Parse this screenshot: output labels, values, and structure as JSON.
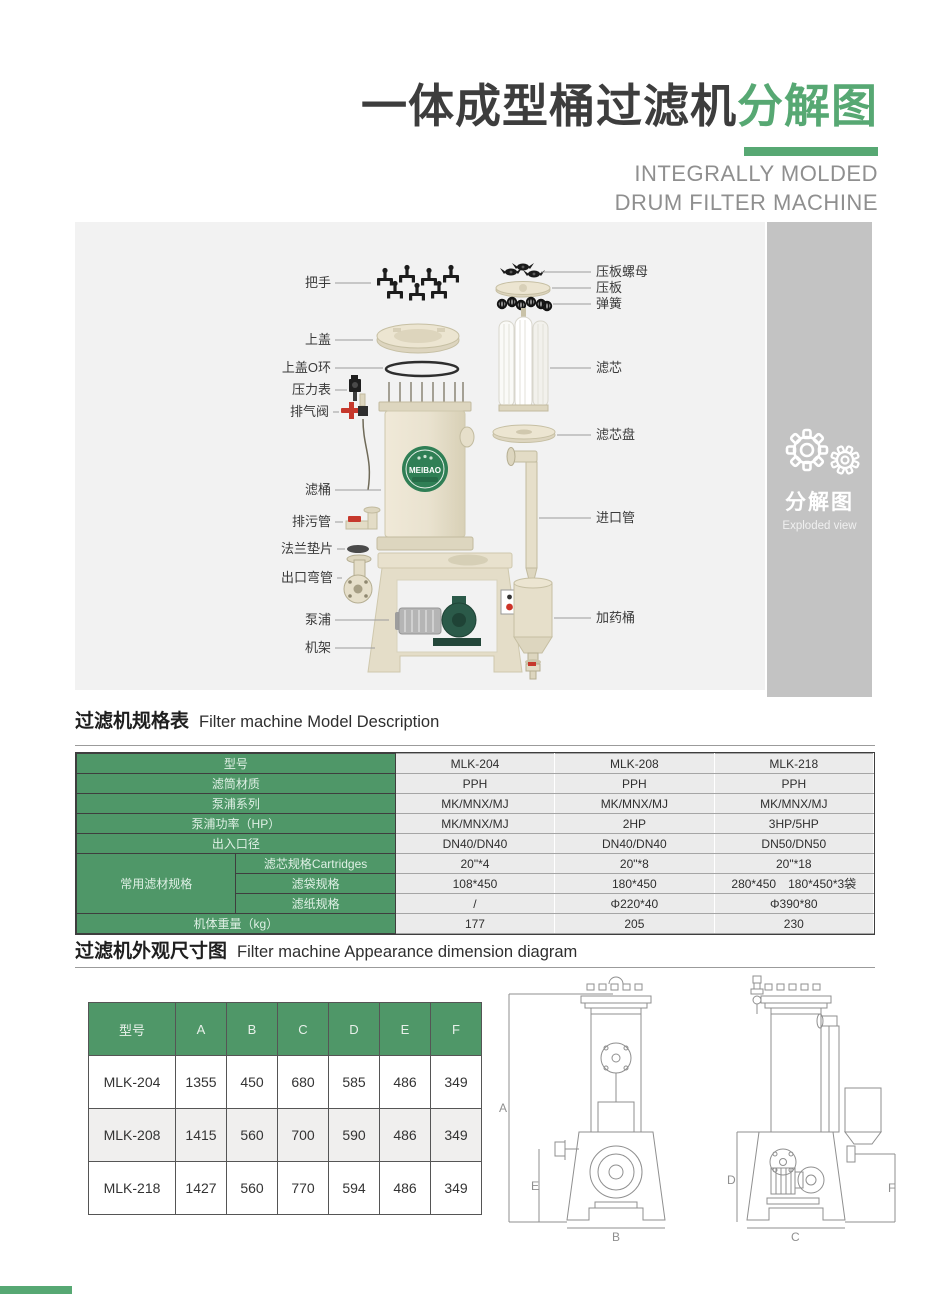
{
  "colors": {
    "accent_green": "#57a873",
    "table_green": "#4f9768",
    "sidebar_gray": "#c3c3c3",
    "panel_gray": "#f2f2f2"
  },
  "title": {
    "zh_main": "一体成型桶过滤机",
    "zh_accent": "分解图",
    "en_line1": "INTEGRALLY MOLDED",
    "en_line2": "DRUM FILTER MACHINE"
  },
  "sidebar": {
    "zh": "分解图",
    "en": "Exploded view"
  },
  "diagram": {
    "drum_logo": "MEIBAO",
    "parts_left": [
      "把手",
      "上盖",
      "上盖O环",
      "压力表",
      "排气阀",
      "滤桶",
      "排污管",
      "法兰垫片",
      "出口弯管",
      "泵浦",
      "机架"
    ],
    "parts_right": [
      "压板螺母",
      "压板",
      "弹簧",
      "滤芯",
      "滤芯盘",
      "进口管",
      "加药桶"
    ]
  },
  "sections": {
    "spec": {
      "zh": "过滤机规格表",
      "en": "Filter machine Model Description"
    },
    "dim": {
      "zh": "过滤机外观尺寸图",
      "en": "Filter machine Appearance dimension diagram"
    }
  },
  "spec_table": {
    "model_row": {
      "label": "型号",
      "values": [
        "MLK-204",
        "MLK-208",
        "MLK-218"
      ]
    },
    "rows": [
      {
        "label": "滤筒材质",
        "values": [
          "PPH",
          "PPH",
          "PPH"
        ]
      },
      {
        "label": "泵浦系列",
        "values": [
          "MK/MNX/MJ",
          "MK/MNX/MJ",
          "MK/MNX/MJ"
        ]
      },
      {
        "label": "泵浦功率（HP）",
        "values": [
          "MK/MNX/MJ",
          "2HP",
          "3HP/5HP"
        ]
      },
      {
        "label": "出入口径",
        "values": [
          "DN40/DN40",
          "DN40/DN40",
          "DN50/DN50"
        ]
      }
    ],
    "media_group": {
      "label": "常用滤材规格",
      "rows": [
        {
          "label": "滤芯规格Cartridges",
          "values": [
            "20\"*4",
            "20\"*8",
            "20\"*18"
          ]
        },
        {
          "label": "滤袋规格",
          "values": [
            "108*450",
            "180*450",
            "280*450　180*450*3袋"
          ]
        },
        {
          "label": "滤纸规格",
          "values": [
            "/",
            "Φ220*40",
            "Φ390*80"
          ]
        }
      ]
    },
    "weight_row": {
      "label": "机体重量（kg）",
      "values": [
        "177",
        "205",
        "230"
      ]
    }
  },
  "dim_table": {
    "headers": [
      "型号",
      "A",
      "B",
      "C",
      "D",
      "E",
      "F"
    ],
    "rows": [
      [
        "MLK-204",
        "1355",
        "450",
        "680",
        "585",
        "486",
        "349"
      ],
      [
        "MLK-208",
        "1415",
        "560",
        "700",
        "590",
        "486",
        "349"
      ],
      [
        "MLK-218",
        "1427",
        "560",
        "770",
        "594",
        "486",
        "349"
      ]
    ]
  },
  "drawing": {
    "labels": [
      "A",
      "B",
      "C",
      "D",
      "E",
      "F"
    ]
  }
}
